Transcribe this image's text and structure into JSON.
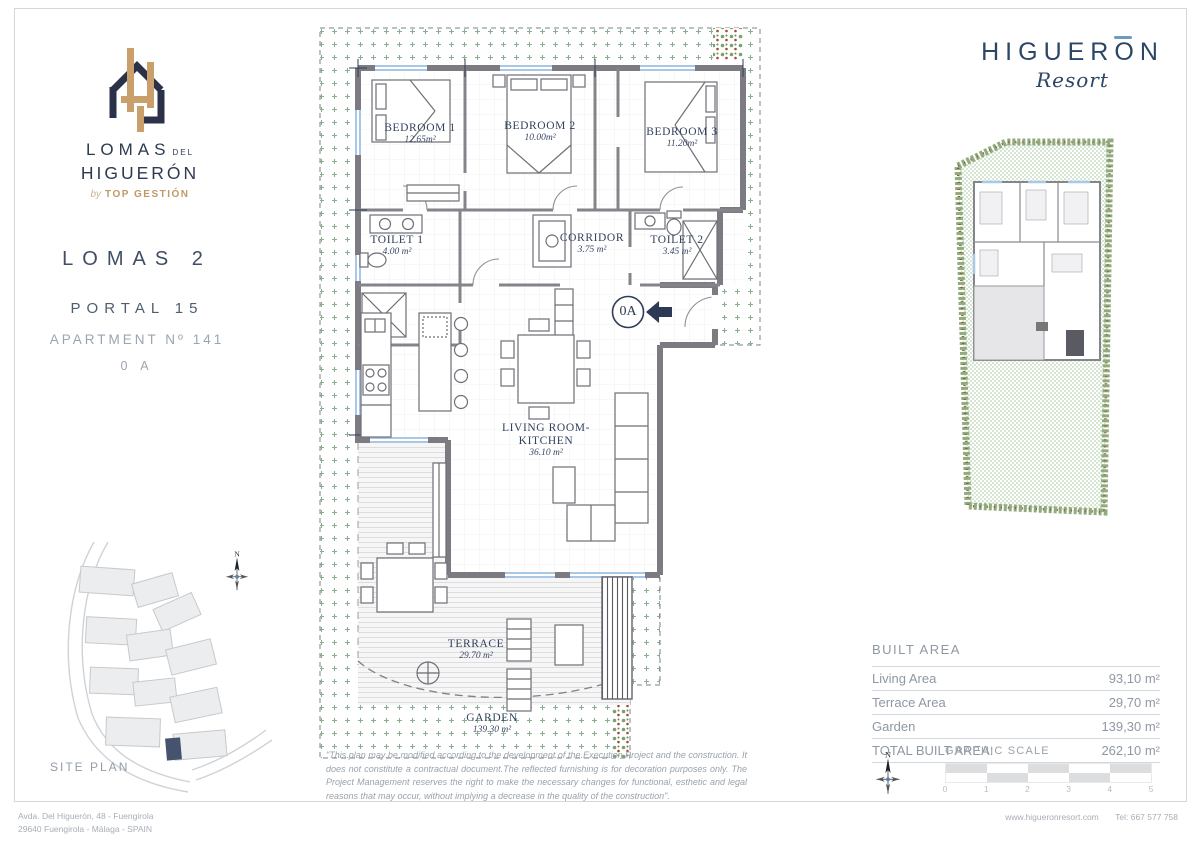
{
  "brand_logo": {
    "line1": "LOMAS",
    "line1_small": "DEL",
    "line2": "HIGUERÓN",
    "by": "by",
    "by_brand": "TOP GESTIÓN"
  },
  "resort_logo": {
    "word_start": "HIGUER",
    "word_o": "O",
    "word_end": "N",
    "script": "Resort"
  },
  "unit_info": {
    "block": "LOMAS 2",
    "portal": "PORTAL 15",
    "apartment": "APARTMENT Nº 141",
    "type": "0 A"
  },
  "floor_plan": {
    "rooms": [
      {
        "name": "BEDROOM 1",
        "area": "12.65m²"
      },
      {
        "name": "BEDROOM 2",
        "area": "10.00m²"
      },
      {
        "name": "BEDROOM 3",
        "area": "11.20m²"
      },
      {
        "name": "TOILET 1",
        "area": "4.00 m²"
      },
      {
        "name": "CORRIDOR",
        "area": "3.75 m²"
      },
      {
        "name": "TOILET 2",
        "area": "3.45 m²"
      },
      {
        "name": "LIVING ROOM-",
        "name2": "KITCHEN",
        "area": "36.10 m²"
      },
      {
        "name": "TERRACE",
        "area": "29.70 m²"
      },
      {
        "name": "GARDEN",
        "area": "139.30 m²"
      }
    ],
    "entrance_label": "0A"
  },
  "site_plan_label": "SITE PLAN",
  "compass_label": "N",
  "built_area": {
    "header": "BUILT AREA",
    "rows": [
      {
        "label": "Living Area",
        "value": "93,10 m²"
      },
      {
        "label": "Terrace Area",
        "value": "29,70 m²"
      },
      {
        "label": "Garden",
        "value": "139,30 m²"
      },
      {
        "label": "TOTAL BUILT AREA:",
        "value": "262,10 m²"
      }
    ]
  },
  "graphic_scale": {
    "label": "GRAPHIC SCALE",
    "ticks": [
      "0",
      "1",
      "2",
      "3",
      "4",
      "5"
    ]
  },
  "disclaimer": "\"This plan may be modified according to the development of the Execution Project and the construction. It does not constitute a contractual document.The reflected furnishing is for decoration purposes only. The Project Management reserves the right to make the necessary changes for functional, esthetic and legal reasons that may occur, without implying a decrease in the quality of the construction\".",
  "footer": {
    "address_line1": "Avda. Del Higuerón, 48 - Fuengirola",
    "address_line2": "29640 Fuengirola - Málaga - SPAIN",
    "website": "www.higueronresort.com",
    "phone": "Tel: 667 577 758"
  },
  "colors": {
    "navy": "#2b3149",
    "gold": "#c9a06c",
    "label_navy": "#31415f",
    "garden_green": "#76a07e",
    "wall_gray": "#7b7b81",
    "window_blue": "#a9c7e6",
    "light_text": "#9aa3ad"
  }
}
